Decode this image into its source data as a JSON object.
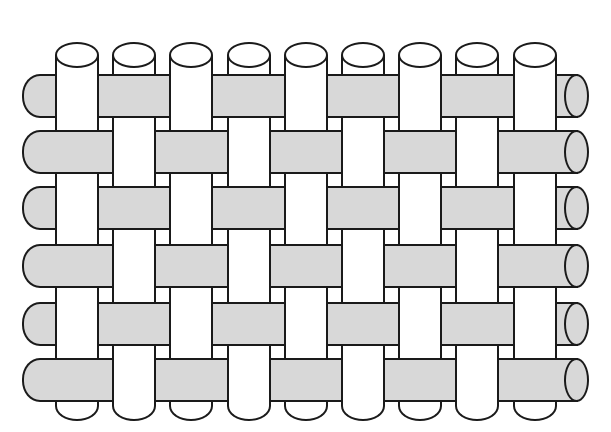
{
  "diagram": {
    "name": "plain-weave-fabric-diagram",
    "description": "Illustration of a plain (1/1) weave: vertical warp threads interlacing alternately with horizontal weft threads",
    "weave_type": "plain weave",
    "canvas": {
      "width": 611,
      "height": 432,
      "background": "#ffffff"
    },
    "colors": {
      "warp_fill": "#ffffff",
      "weft_fill": "#d8d8d8",
      "outline": "#1a1a1a",
      "outline_width": 2
    },
    "warp": {
      "count": 9,
      "orientation": "vertical",
      "width": 44,
      "centers_x": [
        77,
        134,
        191,
        249,
        306,
        363,
        420,
        477,
        535
      ],
      "ellipse_top_y": 42,
      "ellipse_height": 26,
      "tube_top_y": 55,
      "tube_bottom_y": 421
    },
    "weft": {
      "count": 6,
      "orientation": "horizontal",
      "height": 44,
      "tops_y": [
        74,
        130,
        186,
        244,
        302,
        358
      ],
      "left_x": 22,
      "tube_right_x": 578,
      "cap_left_x": 564,
      "cap_width": 25
    },
    "weave": {
      "odd_row_over_warps": [
        1,
        3,
        5,
        7,
        9
      ],
      "even_row_over_warps": [
        2,
        4,
        6,
        8
      ],
      "rule": "weft rows 1,3,5 pass over warps 2,4,6,8 and under warps 1,3,5,7,9; weft rows 2,4,6 pass over warps 1,3,5,7,9 and under warps 2,4,6,8"
    }
  }
}
